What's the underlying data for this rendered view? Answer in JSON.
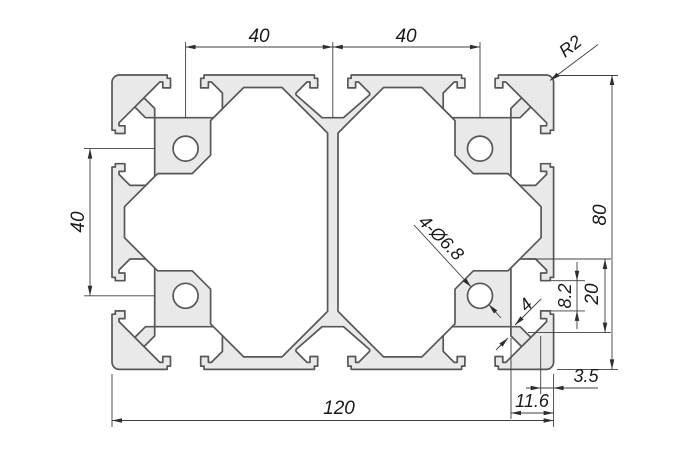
{
  "title": "Aluminium profile 80x120 cross-section drawing",
  "colors": {
    "background": "#ffffff",
    "profile_fill": "#e9e9e9",
    "outline": "#575757",
    "dimension_lines": "#3f3f3f",
    "text": "#1a1a1a"
  },
  "dims": {
    "top_spans": [
      "40",
      "40"
    ],
    "left_span": "40",
    "height": "80",
    "width": "120",
    "corner_radius": "R2",
    "holes": "4-Ø6.8",
    "slot_wall": "4",
    "slot_opening": "8.2",
    "slot_inner_width": "20",
    "edge_wall": "3.5",
    "slot_depth": "11.6"
  }
}
